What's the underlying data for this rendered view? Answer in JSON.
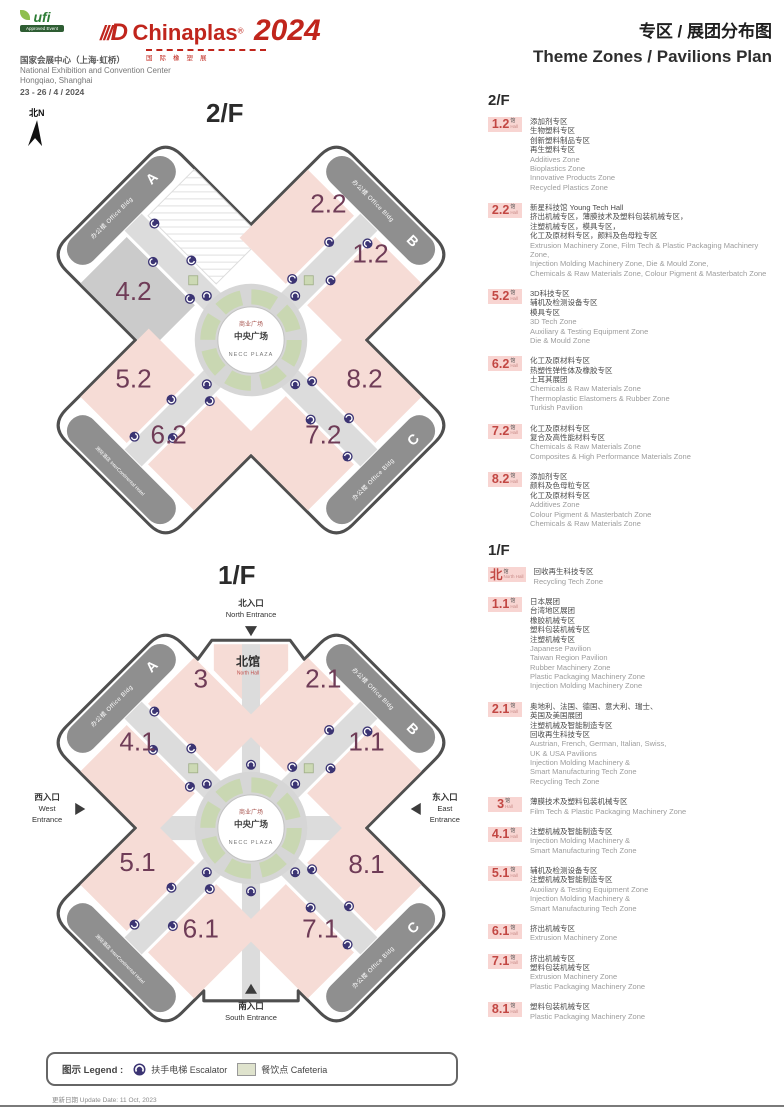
{
  "header": {
    "ufi": "ufi",
    "ufi_sub": "Approved Event",
    "brand_slashes": "///",
    "brand_d": "D",
    "brand_name": "Chinaplas",
    "brand_reg": "®",
    "brand_year": "2024",
    "brand_sub": "国际橡塑展",
    "venue_zh": "国家会展中心（上海·虹桥）",
    "venue_en": "National Exhibition and Convention Center",
    "venue_city": "Hongqiao, Shanghai",
    "dates": "23 - 26 / 4 / 2024",
    "title_zh": "专区 / 展团分布图",
    "title_en": "Theme Zones / Pavilions Plan"
  },
  "map_common": {
    "office": "办公楼 Office Bldg",
    "wing_a": "A",
    "wing_b": "B",
    "wing_c": "C",
    "hotel": "洲际酒店 InterContinental Hotel",
    "plaza_top": "商业广场",
    "plaza_mid": "中央广场",
    "plaza_bottom": "NECC PLAZA"
  },
  "f2_map": {
    "floor": "2/F",
    "compass": "北N",
    "halls": [
      "2.2",
      "1.2",
      "4.2",
      "5.2",
      "6.2",
      "7.2",
      "8.2"
    ]
  },
  "f1_map": {
    "floor": "1/F",
    "north_hall_zh": "北馆",
    "north_hall_en": "North Hall",
    "halls": [
      "3",
      "2.1",
      "4.1",
      "1.1",
      "5.1",
      "6.1",
      "7.1",
      "8.1"
    ],
    "entrance_north_zh": "北入口",
    "entrance_north_en": "North Entrance",
    "entrance_south_zh": "南入口",
    "entrance_south_en": "South Entrance",
    "entrance_west_zh": "西入口",
    "entrance_west_en1": "West",
    "entrance_west_en2": "Entrance",
    "entrance_east_zh": "东入口",
    "entrance_east_en1": "East",
    "entrance_east_en2": "Entrance"
  },
  "sidebar": {
    "f2_header": "2/F",
    "f1_header": "1/F",
    "f2": [
      {
        "num": "1.2",
        "suf_zh": "馆",
        "suf_en": "Hall",
        "zh": "添加剂专区\n生物塑料专区\n创新塑料制品专区\n再生塑料专区",
        "en": "Additives Zone\nBioplastics Zone\nInnovative Products Zone\nRecycled Plastics Zone"
      },
      {
        "num": "2.2",
        "suf_zh": "馆",
        "suf_en": "Hall",
        "zh": "新星科技馆 Young Tech Hall\n挤出机械专区，薄膜技术及塑料包装机械专区，\n注塑机械专区，模具专区，\n化工及原材料专区，颜料及色母粒专区",
        "en": "Extrusion Machinery Zone, Film Tech & Plastic Packaging Machinery Zone,\nInjection Molding Machinery Zone, Die & Mould Zone,\nChemicals & Raw Materials Zone, Colour Pigment & Masterbatch Zone"
      },
      {
        "num": "5.2",
        "suf_zh": "馆",
        "suf_en": "Hall",
        "zh": "3D科技专区\n辅机及检测设备专区\n模具专区",
        "en": "3D Tech Zone\nAuxiliary & Testing Equipment Zone\nDie & Mould Zone"
      },
      {
        "num": "6.2",
        "suf_zh": "馆",
        "suf_en": "Hall",
        "zh": "化工及原材料专区\n热塑性弹性体及橡胶专区\n土耳其展团",
        "en": "Chemicals & Raw Materials Zone\nThermoplastic Elastomers & Rubber Zone\nTurkish Pavilion"
      },
      {
        "num": "7.2",
        "suf_zh": "馆",
        "suf_en": "Hall",
        "zh": "化工及原材料专区\n复合及高性能材料专区",
        "en": "Chemicals & Raw Materials Zone\nComposites & High Performance Materials Zone"
      },
      {
        "num": "8.2",
        "suf_zh": "馆",
        "suf_en": "Hall",
        "zh": "添加剂专区\n颜料及色母粒专区\n化工及原材料专区",
        "en": "Additives Zone\nColour Pigment & Masterbatch Zone\nChemicals & Raw Materials Zone"
      }
    ],
    "f1": [
      {
        "num": "北",
        "suf_zh": "馆",
        "suf_en": "North Hall",
        "zh": "回收再生科技专区",
        "en": "Recycling Tech Zone"
      },
      {
        "num": "1.1",
        "suf_zh": "馆",
        "suf_en": "Hall",
        "zh": "日本展团\n台湾地区展团\n橡胶机械专区\n塑料包装机械专区\n注塑机械专区",
        "en": "Japanese Pavilion\nTaiwan Region Pavilion\nRubber Machinery Zone\nPlastic Packaging Machinery Zone\nInjection Molding Machinery Zone"
      },
      {
        "num": "2.1",
        "suf_zh": "馆",
        "suf_en": "Hall",
        "zh": "奥地利、法国、德国、意大利、瑞士、\n英国及美国展团\n注塑机械及智能制造专区\n回收再生科技专区",
        "en": "Austrian, French, German, Italian, Swiss,\nUK & USA Pavilions\nInjection Molding Machinery &\nSmart Manufacturing Tech Zone\nRecycling Tech Zone"
      },
      {
        "num": "3",
        "suf_zh": "馆",
        "suf_en": "Hall",
        "zh": "薄膜技术及塑料包装机械专区",
        "en": "Film Tech & Plastic Packaging Machinery Zone"
      },
      {
        "num": "4.1",
        "suf_zh": "馆",
        "suf_en": "Hall",
        "zh": "注塑机械及智能制造专区",
        "en": "Injection Molding Machinery &\nSmart Manufacturing Tech Zone"
      },
      {
        "num": "5.1",
        "suf_zh": "馆",
        "suf_en": "Hall",
        "zh": "辅机及检测设备专区\n注塑机械及智能制造专区",
        "en": "Auxiliary & Testing Equipment Zone\nInjection Molding Machinery &\nSmart Manufacturing Tech Zone"
      },
      {
        "num": "6.1",
        "suf_zh": "馆",
        "suf_en": "Hall",
        "zh": "挤出机械专区",
        "en": "Extrusion Machinery Zone"
      },
      {
        "num": "7.1",
        "suf_zh": "馆",
        "suf_en": "Hall",
        "zh": "挤出机械专区\n塑料包装机械专区",
        "en": "Extrusion Machinery Zone\nPlastic Packaging Machinery Zone"
      },
      {
        "num": "8.1",
        "suf_zh": "馆",
        "suf_en": "Hall",
        "zh": "塑料包装机械专区",
        "en": "Plastic Packaging Machinery Zone"
      }
    ]
  },
  "legend": {
    "label": "图示 Legend :",
    "escalator": "扶手电梯 Escalator",
    "cafeteria": "餐饮点 Cafeteria"
  },
  "footer": {
    "update": "更新日期 Update Date: 11 Oct, 2023"
  }
}
